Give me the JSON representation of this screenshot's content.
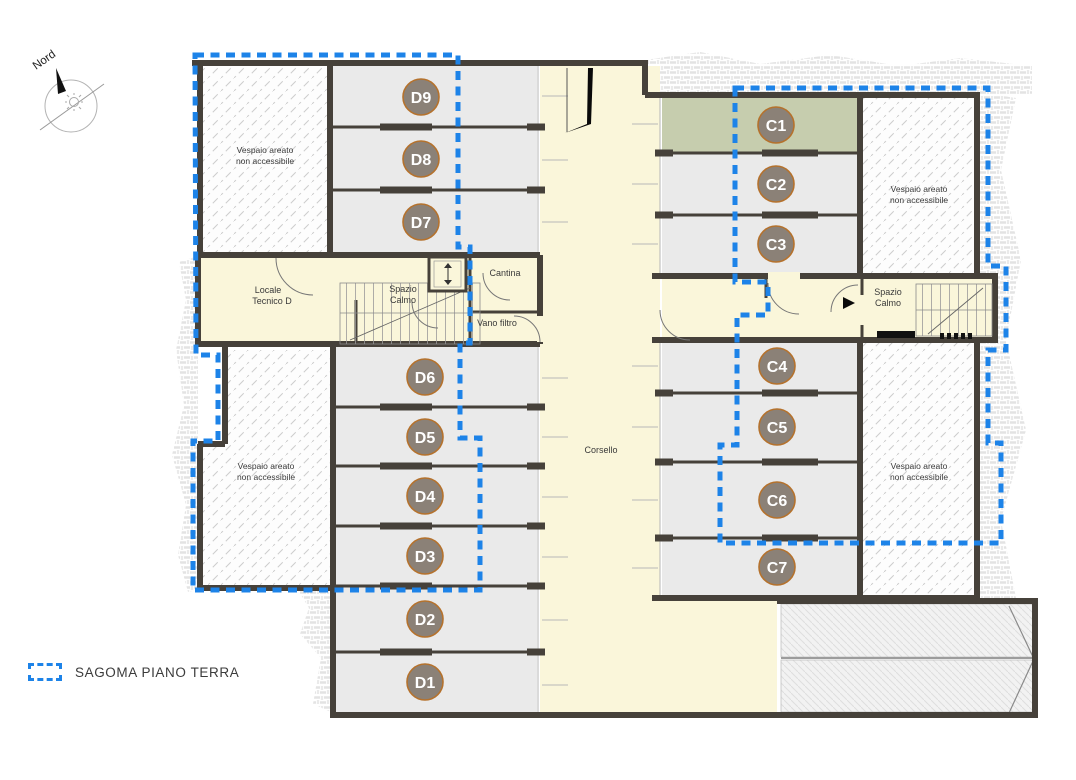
{
  "compass": {
    "label": "Nord"
  },
  "legend": {
    "label": "SAGOMA PIANO TERRA",
    "line_color": "#1d83e8"
  },
  "areas": {
    "vespaio": {
      "line1": "Vespaio areato",
      "line2": "non accessibile"
    },
    "locale_tecnico": {
      "line1": "Locale",
      "line2": "Tecnico D"
    },
    "spazio_calmo": {
      "line1": "Spazio",
      "line2": "Calmo"
    },
    "cantina": "Cantina",
    "vano_filtro": "Vano filtro",
    "corsello": "Corsello"
  },
  "stalls": {
    "d": [
      "D9",
      "D8",
      "D7",
      "D6",
      "D5",
      "D4",
      "D3",
      "D2",
      "D1"
    ],
    "c": [
      "C1",
      "C2",
      "C3",
      "C4",
      "C5",
      "C6",
      "C7"
    ]
  },
  "colors": {
    "sagoma_blue": "#1d83e8",
    "wall": "#46413a",
    "stall_gray": "#eaeaea",
    "floor_cream": "#faf6da",
    "c1_green": "#c6cdae",
    "badge_fill": "#8b8177",
    "badge_ring": "#b5722d"
  }
}
